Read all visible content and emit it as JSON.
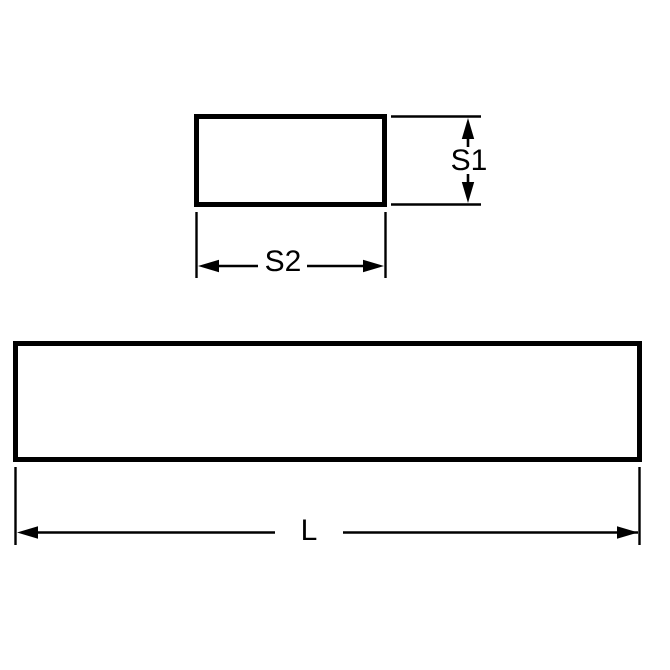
{
  "diagram": {
    "type": "technical-drawing",
    "background_color": "#ffffff",
    "line_color": "#000000",
    "labels": {
      "s1": "S1",
      "s2": "S2",
      "length": "L"
    }
  }
}
